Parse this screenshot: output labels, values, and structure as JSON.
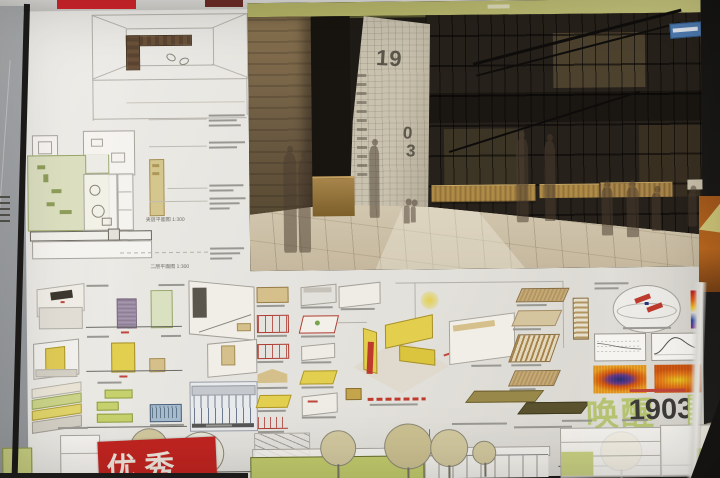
{
  "title_block": {
    "green_text": "唤醒",
    "year_text": "1903"
  },
  "award_stamp": {
    "text": "优秀"
  },
  "tower": {
    "digits_top": "19",
    "digit_mid": "0",
    "digit_bottom": "3"
  },
  "plan_captions": {
    "mezzanine": "夹层平面图 1:300",
    "second_floor": "二层平面图 1:300"
  },
  "colors": {
    "poster_white": "#eceae5",
    "title_green": "#b9c873",
    "title_dark": "#3a3a36",
    "stamp_red": "#c5231f",
    "band_olive": "#b9ba6e",
    "wall_brown": "#6f6046",
    "tower_beige": "#c9c2ad",
    "floor_beige": "#cfc3a8",
    "plan_green": "#dfe3c3",
    "diagram_yellow": "#e6d34f",
    "diagram_green": "#c9d66e",
    "diagram_blue": "#a9c0d4",
    "heatmap_orange": "#e87818",
    "heatmap_blue": "#22307e",
    "sign_blue": "#4d7cb2"
  }
}
